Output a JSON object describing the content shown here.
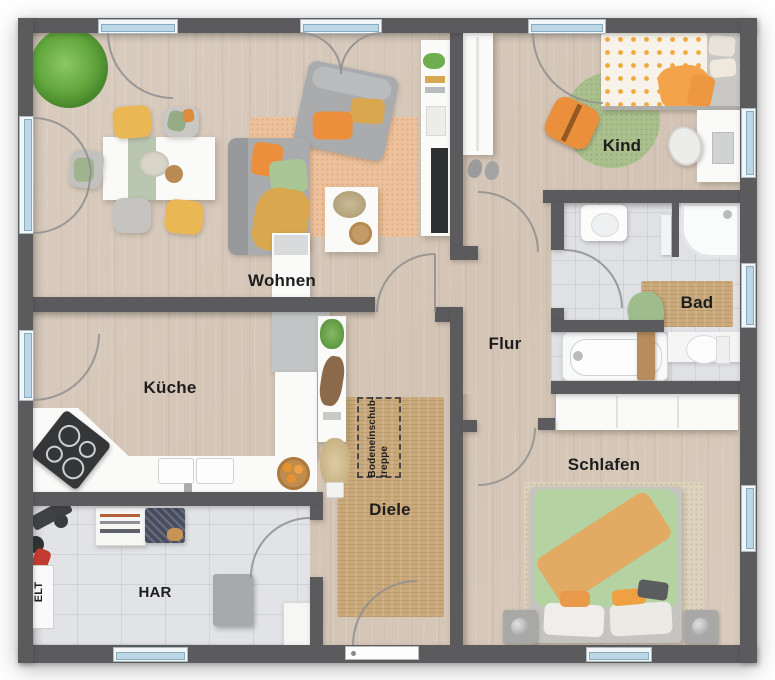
{
  "labels": {
    "wohnen": "Wohnen",
    "kueche": "Küche",
    "kind": "Kind",
    "bad": "Bad",
    "flur": "Flur",
    "diele": "Diele",
    "schlafen": "Schlafen",
    "har": "HAR",
    "elt": "ELT",
    "loft_ladder": "Bodeneinschub-\ntreppe"
  },
  "colors": {
    "wall": "#5b5b5e",
    "floor_wood": "#d6c8ba",
    "floor_tile": "#e2e3e6",
    "window_glass": "#bcd8e7",
    "rug_orange": "#eec19b",
    "rug_jute": "#c9a87a",
    "rug_child_green": "#a9c08d",
    "bed_green": "#b5d2a2",
    "accent_orange": "#ec8f3c",
    "accent_mustard": "#d9a84e",
    "accent_yellow": "#e9b854",
    "accent_green": "#a9c695",
    "label_text": "#1d1d1d"
  }
}
